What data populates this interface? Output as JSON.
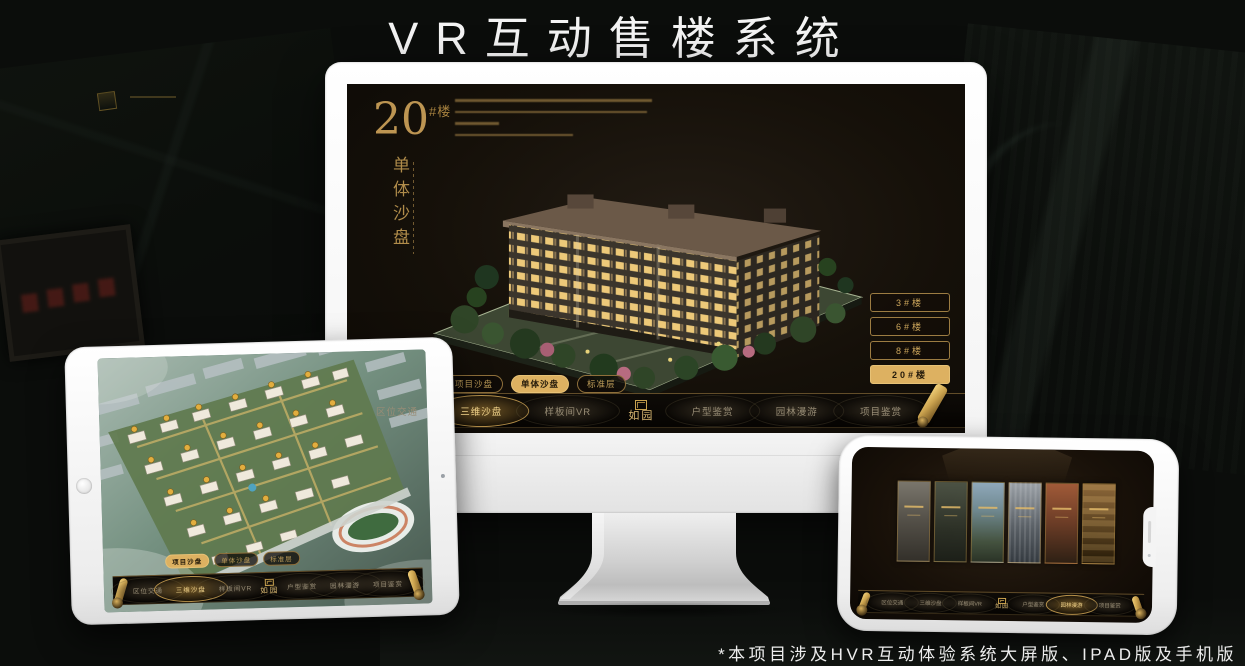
{
  "header": {
    "title": "VR互动售楼系统"
  },
  "footer": {
    "note": "*本项目涉及HVR互动体验系统大屏版、IPAD版及手机版"
  },
  "brand": {
    "logo": "如园"
  },
  "nav": {
    "items": [
      "区位交通",
      "三维沙盘",
      "样板间VR",
      "户型鉴赏",
      "园林漫游",
      "项目鉴赏"
    ],
    "selected_monitor": "三维沙盘",
    "selected_tablet": "三维沙盘",
    "selected_phone": "园林漫游"
  },
  "sub_tabs": {
    "items": [
      "项目沙盘",
      "单体沙盘",
      "标准层"
    ],
    "selected_monitor": "单体沙盘",
    "selected_tablet": "项目沙盘"
  },
  "monitor_screen": {
    "heading_number": "20",
    "heading_suffix": "#楼",
    "heading_vertical": "单体沙盘",
    "floor_buttons": [
      "3#楼",
      "6#楼",
      "8#楼",
      "20#楼"
    ],
    "selected_floor": "20#楼"
  },
  "icons": {
    "scroll": "scroll-ornament",
    "seal": "seal-stamp",
    "home": "tablet-home-button",
    "camera": "front-camera"
  },
  "colors": {
    "gold": "#caa24e",
    "gold_selected": "#ddb161",
    "screen_bg": "#17110a",
    "page_bg": "#0b0d0b",
    "title_text": "#f4f4f4"
  }
}
